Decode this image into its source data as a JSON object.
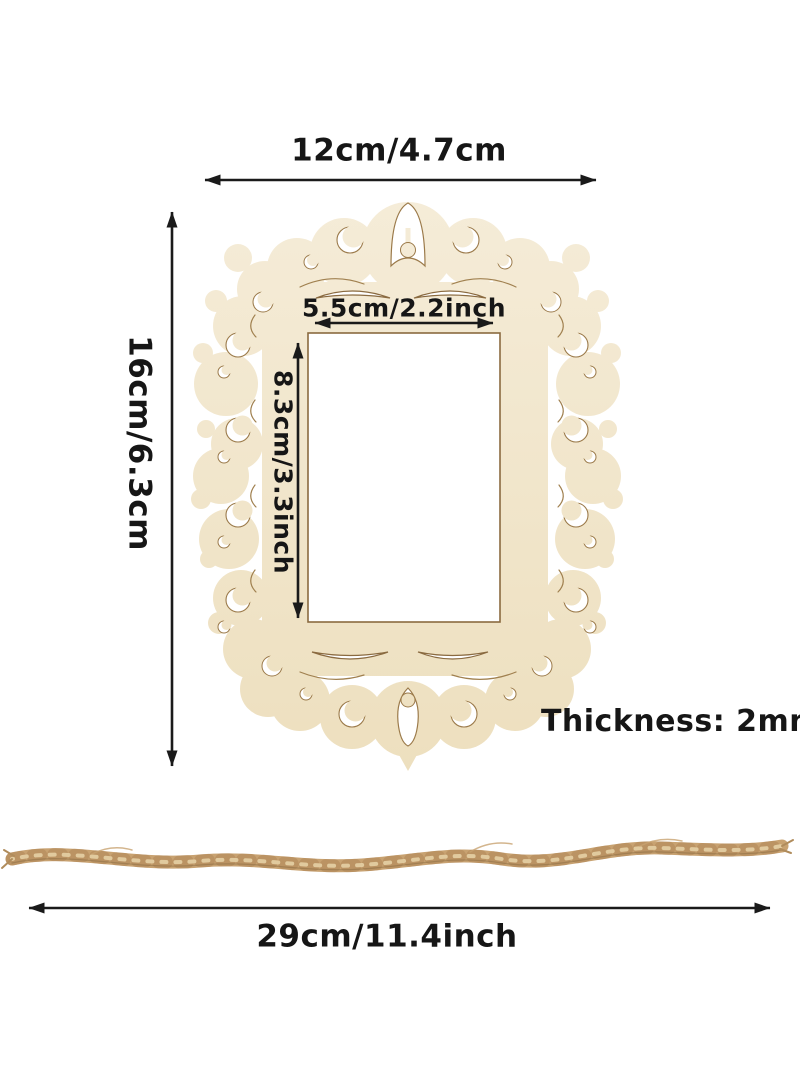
{
  "diagram": {
    "frame": {
      "outer_width_label": "12cm/4.7cm",
      "outer_height_label": "16cm/6.3cm",
      "inner_width_label": "5.5cm/2.2inch",
      "inner_height_label": "8.3cm/3.3inch",
      "thickness_label": "Thickness: 2mm"
    },
    "rope": {
      "length_label": "29cm/11.4inch"
    },
    "colors": {
      "background": "#ffffff",
      "wood_light": "#f5ecd8",
      "wood_dark": "#eddfbe",
      "wood_cut_edge": "#9b7a4a",
      "window": "#ffffff",
      "rope_base": "#c8a271",
      "rope_shadow": "#aa8152",
      "rope_highlight": "#e7d3a8",
      "dimension_line": "#1a1a1a"
    }
  }
}
